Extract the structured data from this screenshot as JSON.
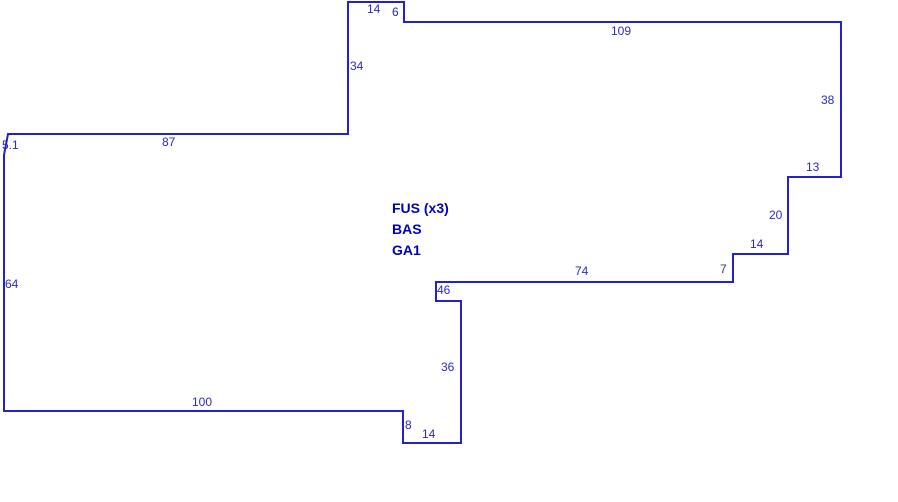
{
  "page": {
    "background_color": "#ffffff"
  },
  "sketch": {
    "canvas_width": 898,
    "canvas_height": 502,
    "outline_color": "#2222c8",
    "outline_width": 2,
    "dimension_text_color": "#2a2ac0",
    "room_text_color": "#0000bb",
    "polygon_points": "348,2 404,2 404,22 841,22 841,177 788,177 788,254 733,254 733,282 436,282 436,301 461,301 461,443 403,443 403,411 4,411 4,155 8,134 348,134",
    "dimensions": [
      {
        "text": "14",
        "x": 367,
        "y": 3
      },
      {
        "text": "6",
        "x": 392,
        "y": 6
      },
      {
        "text": "109",
        "x": 611,
        "y": 25
      },
      {
        "text": "34",
        "x": 350,
        "y": 60
      },
      {
        "text": "38",
        "x": 821,
        "y": 94
      },
      {
        "text": "5.1",
        "x": 2,
        "y": 139
      },
      {
        "text": "87",
        "x": 162,
        "y": 136
      },
      {
        "text": "13",
        "x": 806,
        "y": 161
      },
      {
        "text": "20",
        "x": 769,
        "y": 209
      },
      {
        "text": "14",
        "x": 750,
        "y": 238
      },
      {
        "text": "7",
        "x": 720,
        "y": 263
      },
      {
        "text": "74",
        "x": 575,
        "y": 265
      },
      {
        "text": "46",
        "x": 437,
        "y": 284
      },
      {
        "text": "64",
        "x": 5,
        "y": 278
      },
      {
        "text": "36",
        "x": 441,
        "y": 361
      },
      {
        "text": "100",
        "x": 192,
        "y": 396
      },
      {
        "text": "8",
        "x": 405,
        "y": 419
      },
      {
        "text": "14",
        "x": 422,
        "y": 428
      }
    ],
    "room_labels": [
      {
        "text": "FUS (x3)",
        "x": 392,
        "y": 201
      },
      {
        "text": "BAS",
        "x": 392,
        "y": 222
      },
      {
        "text": "GA1",
        "x": 392,
        "y": 243
      }
    ]
  }
}
